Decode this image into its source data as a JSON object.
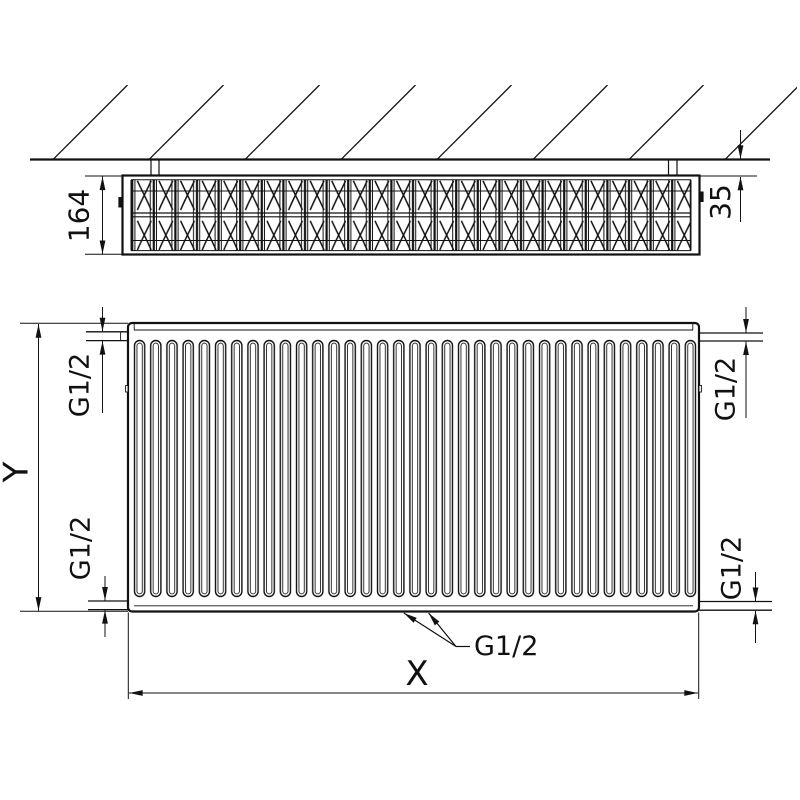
{
  "colors": {
    "background": "#ffffff",
    "ink": "#111111"
  },
  "top_view": {
    "depth_dim": "164",
    "wall_gap_dim": "35"
  },
  "front_view": {
    "height_dim": "Y",
    "width_dim": "X",
    "conn_top_left": "G1/2",
    "conn_top_right": "G1/2",
    "conn_bottom_left": "G1/2",
    "conn_bottom_right": "G1/2",
    "conn_bottom_center": "G1/2"
  }
}
